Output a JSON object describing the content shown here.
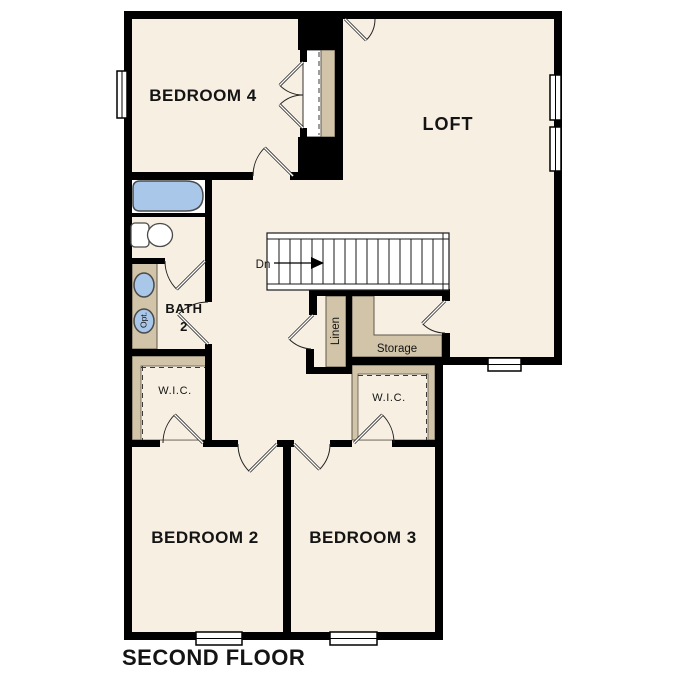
{
  "plan": {
    "title": "SECOND FLOOR",
    "labels": {
      "bedroom4": "BEDROOM 4",
      "loft": "LOFT",
      "bath_line1": "BATH",
      "bath_line2": "2",
      "wic_left": "W.I.C.",
      "wic_right": "W.I.C.",
      "bedroom2": "BEDROOM 2",
      "bedroom3": "BEDROOM 3",
      "linen": "Linen",
      "storage": "Storage",
      "stairs_direction": "Dn",
      "optional_fixture": "Opt."
    },
    "colors": {
      "background": "#ffffff",
      "floor": "#f7efe2",
      "wall": "#000000",
      "casework": "#d1c4a9",
      "fixture": "#a9c8e9"
    }
  }
}
